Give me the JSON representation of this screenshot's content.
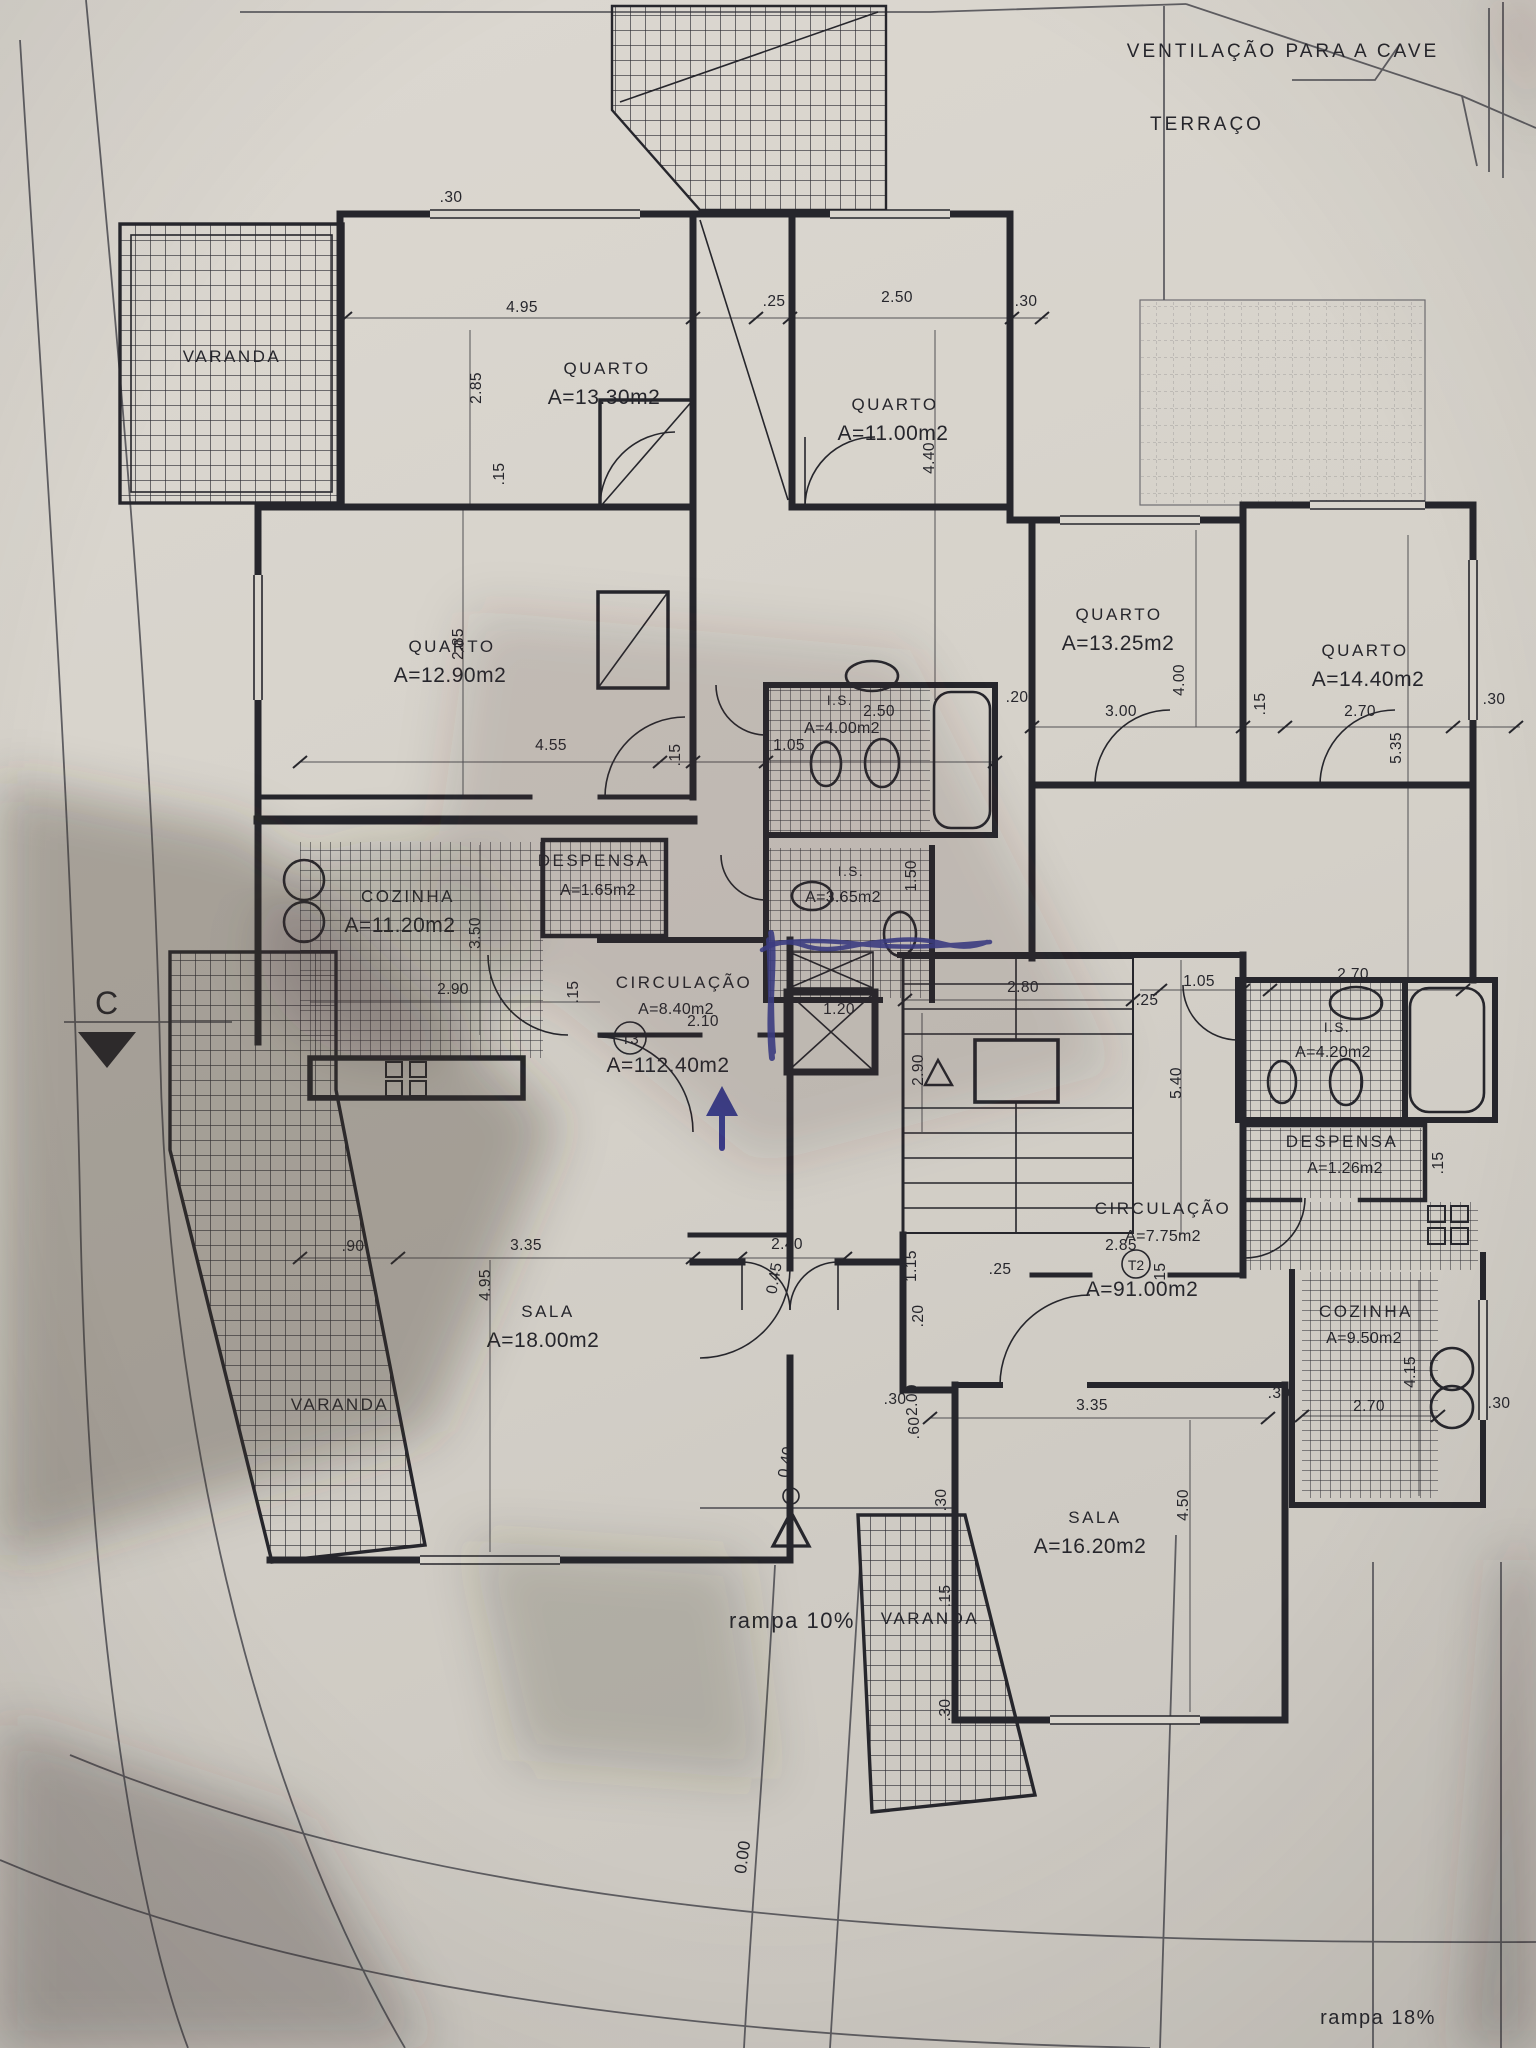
{
  "colors": {
    "paper": "#d8d4cc",
    "ink": "#26262c",
    "pen": "#3a3e8e",
    "shadow": "#3a332c"
  },
  "top_labels": {
    "ventilacao": "VENTILAÇÃO PARA A CAVE",
    "terraco": "TERRAÇO"
  },
  "section_marker": "C",
  "ramps": {
    "left": "rampa 10%",
    "right": "rampa 18%"
  },
  "levels": {
    "zero": "0.00",
    "entry": "0.40"
  },
  "apartments": {
    "t3": {
      "code": "T3",
      "area": "A=112.40m2"
    },
    "t2": {
      "code": "T2",
      "area": "A=91.00m2"
    }
  },
  "rooms": {
    "varanda": "VARANDA",
    "quarto1": {
      "name": "QUARTO",
      "area": "A=13.30m2"
    },
    "quarto2": {
      "name": "QUARTO",
      "area": "A=11.00m2"
    },
    "quarto3": {
      "name": "QUARTO",
      "area": "A=12.90m2"
    },
    "quarto4": {
      "name": "QUARTO",
      "area": "A=13.25m2"
    },
    "quarto5": {
      "name": "QUARTO",
      "area": "A=14.40m2"
    },
    "cozinha_t3": {
      "name": "COZINHA",
      "area": "A=11.20m2"
    },
    "despensa_t3": {
      "name": "DESPENSA",
      "area": "A=1.65m2"
    },
    "circulacao_t3": {
      "name": "CIRCULAÇÃO",
      "area": "A=8.40m2"
    },
    "is1": {
      "name": "I.S.",
      "area": "A=4.00m2"
    },
    "is2": {
      "name": "I.S.",
      "area": "A=3.65m2"
    },
    "is3": {
      "name": "I.S.",
      "area": "A=4.20m2"
    },
    "despensa_t2": {
      "name": "DESPENSA",
      "area": "A=1.26m2"
    },
    "circulacao_t2": {
      "name": "CIRCULAÇÃO",
      "area": "A=7.75m2"
    },
    "cozinha_t2": {
      "name": "COZINHA",
      "area": "A=9.50m2"
    },
    "sala_t3": {
      "name": "SALA",
      "area": "A=18.00m2"
    },
    "sala_t2": {
      "name": "SALA",
      "area": "A=16.20m2"
    }
  },
  "dims": {
    "v015": ".15",
    "v020": ".20",
    "v025": ".25",
    "v030": ".30",
    "v045": "0.45",
    "v060": ".60",
    "v090": ".90",
    "v105": "1.05",
    "v115": "1.15",
    "v120": "1.20",
    "v150": "1.50",
    "v200": "2.00",
    "v210": "2.10",
    "v240": "2.40",
    "v250": "2.50",
    "v270": "2.70",
    "v280": "2.80",
    "v285": "2.85",
    "v290": "2.90",
    "v300": "3.00",
    "v335": "3.35",
    "v350": "3.50",
    "v400": "4.00",
    "v415": "4.15",
    "v440": "4.40",
    "v450": "4.50",
    "v455": "4.55",
    "v495": "4.95",
    "v535": "5.35",
    "v540": "5.40"
  }
}
